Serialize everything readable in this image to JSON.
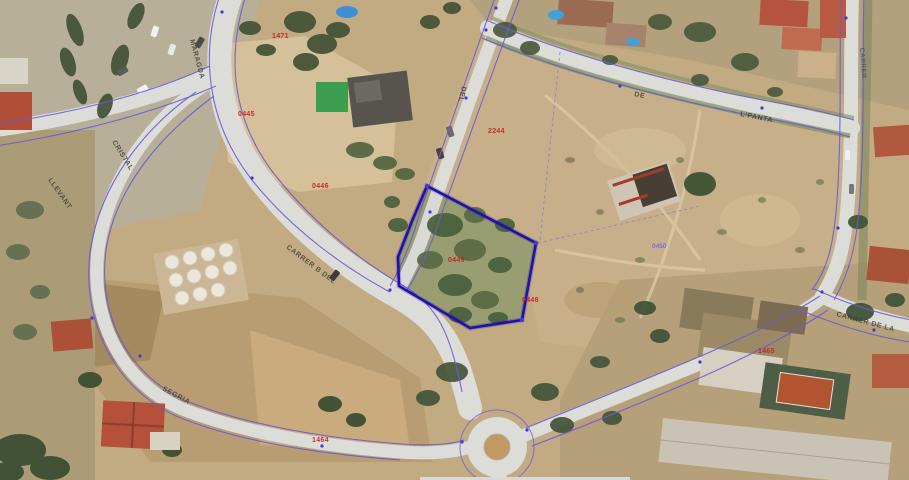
{
  "map": {
    "kind": "aerial-orthophoto-with-cadastral-overlay",
    "colors": {
      "overlay_line": "#6a5bd8",
      "parcel_highlight": "#2012a8",
      "parcel_label_red": "#c41f1f",
      "overlay_label_purple": "#7b5ff0",
      "road": "#dcdcd8",
      "earth": "#c2ab83"
    }
  },
  "street_labels": [
    {
      "text": "MARAGDA"
    },
    {
      "text": "CRISTAL"
    },
    {
      "text": "LLEVANT"
    },
    {
      "text": "CARRER B DEL"
    },
    {
      "text": "DEL"
    },
    {
      "text": "DE"
    },
    {
      "text": "L'PANTA"
    },
    {
      "text": "SEGRIA"
    },
    {
      "text": "CARRER DE LA"
    },
    {
      "text": "CARRER"
    }
  ],
  "parcel_labels": [
    {
      "text": "1471"
    },
    {
      "text": "0445"
    },
    {
      "text": "0446"
    },
    {
      "text": "2244"
    },
    {
      "text": "0449"
    },
    {
      "text": "0448"
    },
    {
      "text": "1465"
    },
    {
      "text": "1464"
    }
  ],
  "overlay_labels": [
    {
      "text": "0450"
    }
  ]
}
